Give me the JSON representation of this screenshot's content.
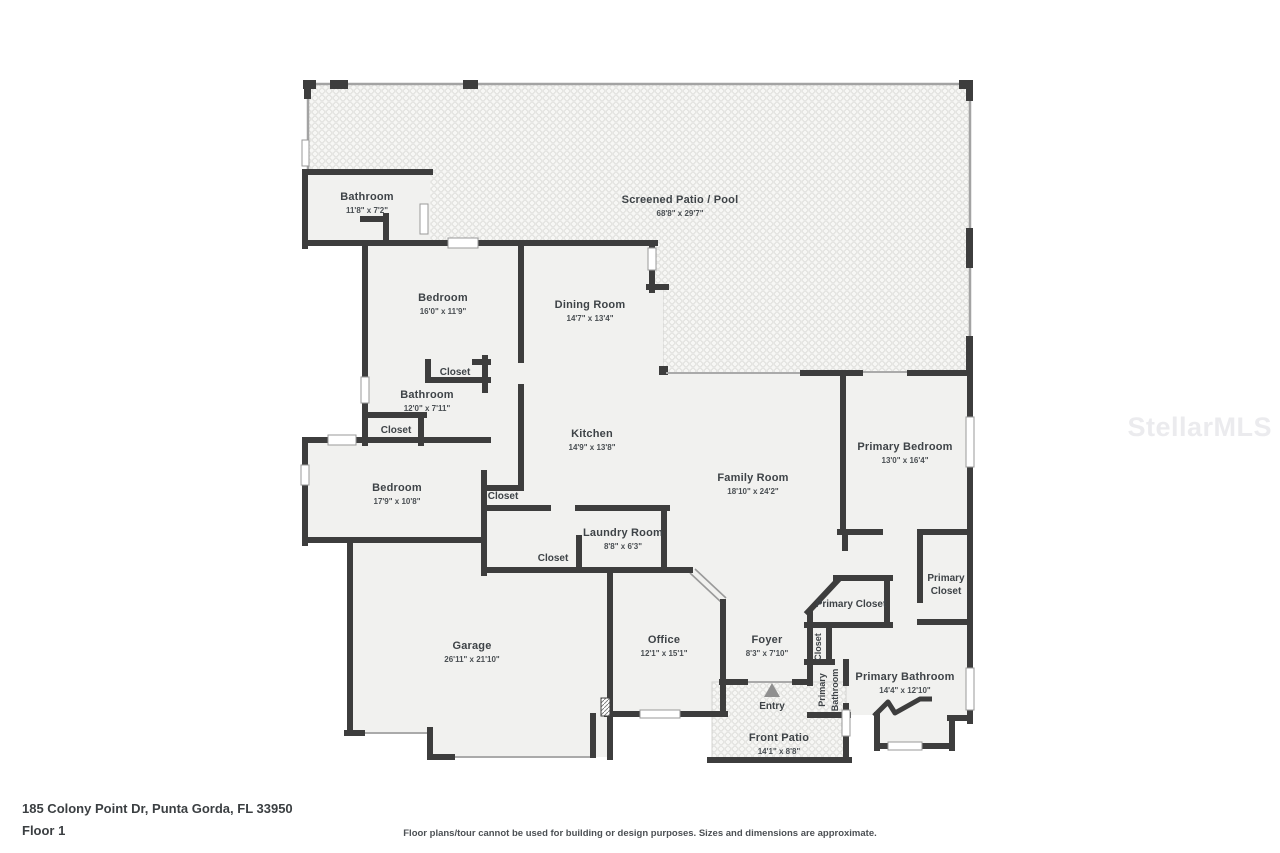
{
  "meta": {
    "address": "185 Colony Point Dr, Punta Gorda, FL 33950",
    "floor_label": "Floor 1",
    "disclaimer": "Floor plans/tour cannot be used for building or design purposes. Sizes and dimensions are approximate.",
    "watermark": "StellarMLS"
  },
  "palette": {
    "wall": "#3d3d3d",
    "room_fill": "#f1f1ef",
    "patio_fill": "#f7f7f5",
    "mesh_line": "#e2e2df",
    "window_stroke": "#9a9a9a",
    "door_line": "#aaaaaa",
    "entry_arrow": "#8f8f8f"
  },
  "rooms": [
    {
      "name": "Screened Patio / Pool",
      "dims": "68'8\" x 29'7\"",
      "x": 680,
      "y": 201
    },
    {
      "name": "Bathroom",
      "dims": "11'8\" x 7'2\"",
      "x": 367,
      "y": 198
    },
    {
      "name": "Bedroom",
      "dims": "16'0\" x 11'9\"",
      "x": 443,
      "y": 299
    },
    {
      "name": "Dining Room",
      "dims": "14'7\" x 13'4\"",
      "x": 590,
      "y": 306
    },
    {
      "name": "Closet",
      "dims": "",
      "x": 455,
      "y": 372
    },
    {
      "name": "Bathroom",
      "dims": "12'0\" x 7'11\"",
      "x": 427,
      "y": 396
    },
    {
      "name": "Closet",
      "dims": "",
      "x": 396,
      "y": 430
    },
    {
      "name": "Bedroom",
      "dims": "17'9\" x 10'8\"",
      "x": 397,
      "y": 489
    },
    {
      "name": "Kitchen",
      "dims": "14'9\" x 13'8\"",
      "x": 592,
      "y": 435
    },
    {
      "name": "Closet",
      "dims": "",
      "x": 503,
      "y": 496
    },
    {
      "name": "Laundry Room",
      "dims": "8'8\" x 6'3\"",
      "x": 623,
      "y": 534
    },
    {
      "name": "Closet",
      "dims": "",
      "x": 553,
      "y": 558
    },
    {
      "name": "Family Room",
      "dims": "18'10\" x 24'2\"",
      "x": 753,
      "y": 479
    },
    {
      "name": "Primary Bedroom",
      "dims": "13'0\" x 16'4\"",
      "x": 905,
      "y": 448
    },
    {
      "name": "Primary Closet",
      "dims": "",
      "x": 851,
      "y": 604
    },
    {
      "name": "Primary Closet",
      "lines": [
        "Primary",
        "Closet"
      ],
      "x": 946,
      "y": 578
    },
    {
      "name": "Garage",
      "dims": "26'11\" x 21'10\"",
      "x": 472,
      "y": 647
    },
    {
      "name": "Office",
      "dims": "12'1\" x 15'1\"",
      "x": 664,
      "y": 641
    },
    {
      "name": "Foyer",
      "dims": "8'3\" x 7'10\"",
      "x": 767,
      "y": 641
    },
    {
      "name": "Closet",
      "dims": "",
      "x": 818,
      "y": 647,
      "vertical": true
    },
    {
      "name": "Primary Bathroom",
      "lines": [
        "Primary",
        "Bathroom"
      ],
      "x": 827,
      "y": 690,
      "vertical": true
    },
    {
      "name": "Primary Bathroom",
      "dims": "14'4\" x 12'10\"",
      "x": 905,
      "y": 678
    },
    {
      "name": "Front Patio",
      "dims": "14'1\" x 8'8\"",
      "x": 779,
      "y": 739
    }
  ],
  "entry": {
    "label": "Entry",
    "x": 772,
    "y": 707
  }
}
